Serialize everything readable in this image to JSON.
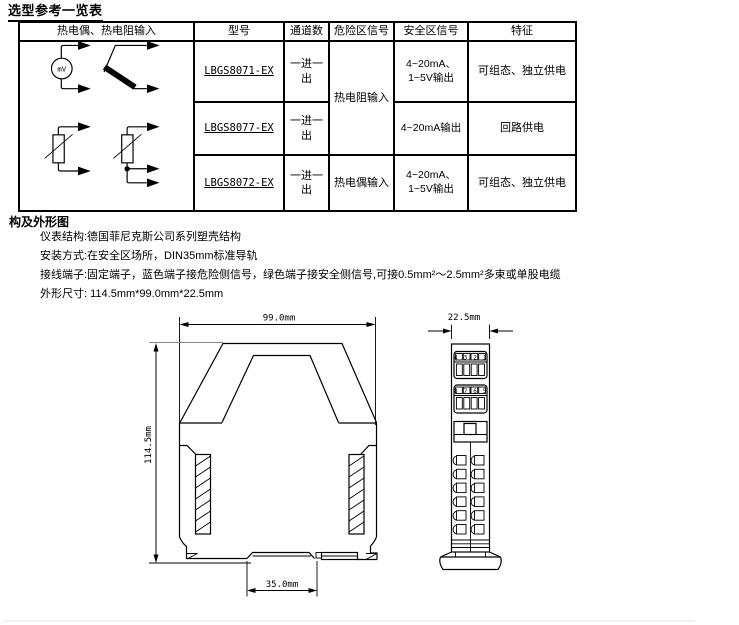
{
  "title": "选型参考一览表",
  "table": {
    "headers": {
      "input": "热电偶、热电阻输入",
      "model": "型号",
      "channels": "通道数",
      "hazard": "危险区信号",
      "safe": "安全区信号",
      "feature": "特征"
    },
    "rows": [
      {
        "model": "LBGS8071-EX",
        "channels": "一进一出",
        "hazard": "热电阻输入",
        "safe": "4~20mA、1~5V输出",
        "feature": "可组态、独立供电"
      },
      {
        "model": "LBGS8077-EX",
        "channels": "一进一出",
        "safe": "4~20mA输出",
        "feature": "回路供电"
      },
      {
        "model": "LBGS8072-EX",
        "channels": "一进一出",
        "hazard": "热电偶输入",
        "safe": "4~20mA、1~5V输出",
        "feature": "可组态、独立供电"
      }
    ],
    "symbols": {
      "mv_label": "mV",
      "names": [
        "mv-source",
        "thermocouple",
        "rtd-2wire",
        "rtd-3wire"
      ]
    }
  },
  "section": {
    "title": "构及外形图",
    "lines": [
      "仪表结构:德国菲尼克斯公司系列塑壳结构",
      "安装方式:在安全区场所，DIN35mm标准导轨",
      "接线端子:固定端子，蓝色端子接危险侧信号，绿色端子接安全侧信号,可接0.5mm²～2.5mm²多束或单股电缆",
      "外形尺寸: 114.5mm*99.0mm*22.5mm"
    ]
  },
  "drawing": {
    "width_label": "99.0mm",
    "height_label": "114.5mm",
    "rail_label": "35.0mm",
    "depth_label": "22.5mm",
    "terminals_top": "4 3 2 1",
    "terminals_bottom": "8 7 6 5"
  }
}
